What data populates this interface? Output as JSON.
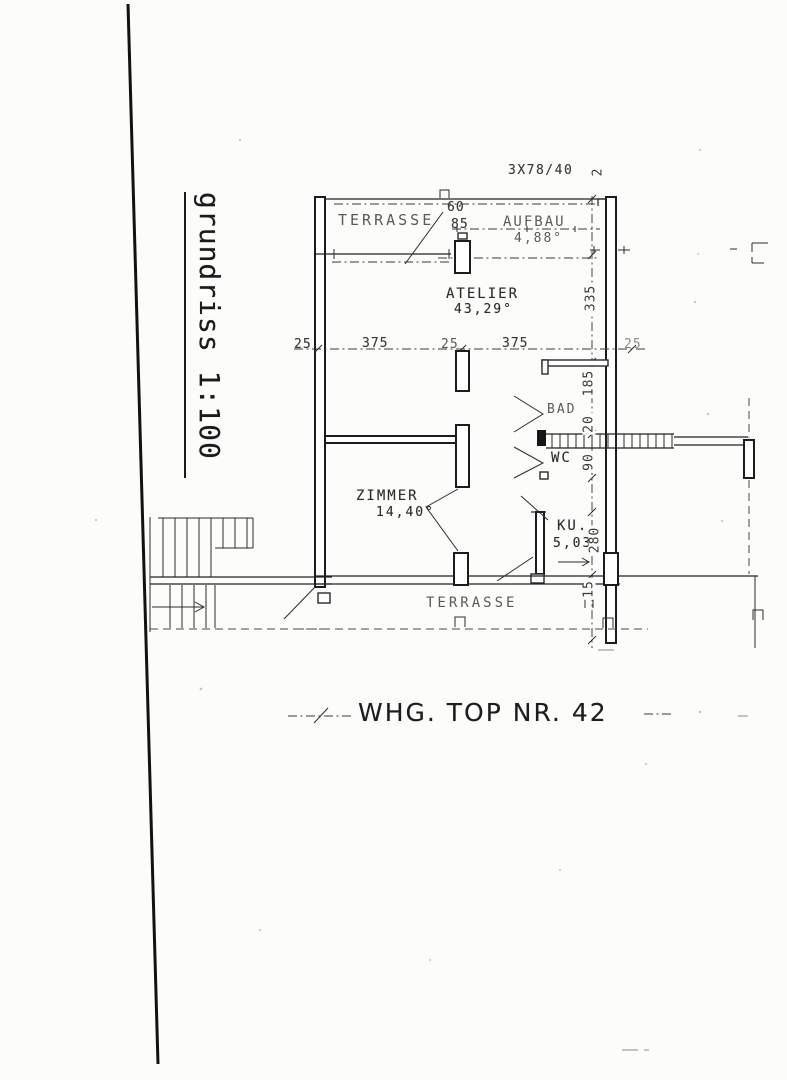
{
  "plan": {
    "scale_label": "grundriss 1:100",
    "caption": "WHG. TOP NR. 42",
    "header_annotation": "3X78/40",
    "rooms": {
      "terrasse_top": "TERRASSE",
      "aufbau": {
        "name": "AUFBAU",
        "area": "4,88°"
      },
      "atelier": {
        "name": "ATELIER",
        "area": "43,29°"
      },
      "bad": "BAD",
      "wc": "WC",
      "zimmer": {
        "name": "ZIMMER",
        "area": "14,40°"
      },
      "kueche": {
        "name": "KU.",
        "area": "5,03°"
      },
      "terrasse_bottom": "TERRASSE"
    },
    "dimensions": {
      "chimney_width": "60",
      "chimney_depth": "85",
      "h1": "25",
      "h2": "375",
      "h3": "25",
      "h4": "375",
      "h5": "25",
      "v0": "2",
      "v1": "335",
      "v2": "185",
      "v3": "20",
      "v4": "90",
      "v5": "280",
      "v6": "15"
    },
    "colors": {
      "ink": "#1c1c1c",
      "paper": "#fcfcfb"
    }
  }
}
